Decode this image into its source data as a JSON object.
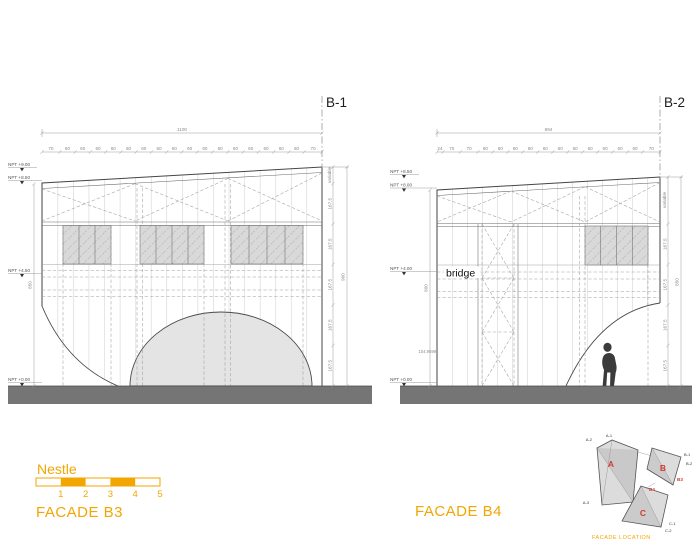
{
  "facade_b3": {
    "title": "FACADE B3",
    "section_label": "B-1",
    "overall_width": "1100",
    "tick_values": [
      "70",
      "60",
      "60",
      "60",
      "60",
      "60",
      "60",
      "60",
      "60",
      "60",
      "60",
      "60",
      "60",
      "60",
      "60",
      "60",
      "60",
      "70"
    ],
    "levels": [
      "NPT  +9.00",
      "NPT  +8.50",
      "NPT  +4.50",
      "NPT  +0.00"
    ],
    "left_height": "850",
    "right_dims": [
      "167.5",
      "167.5",
      "167.5",
      "167.5",
      "167.5"
    ],
    "variable_label": "variable",
    "overall_height": "900"
  },
  "facade_b4": {
    "title": "FACADE B4",
    "section_label": "B-2",
    "overall_width": "894",
    "tick_values": [
      "24",
      "70",
      "70",
      "60",
      "60",
      "60",
      "60",
      "60",
      "60",
      "60",
      "60",
      "60",
      "60",
      "60",
      "70"
    ],
    "levels": [
      "NPT  +8.50",
      "NPT  +8.00",
      "NPT  +4.00",
      "NPT  +0.00"
    ],
    "bridge_label": "bridge",
    "note": "104.9599",
    "left_height": "800",
    "right_dims": [
      "167.5",
      "167.5",
      "167.5",
      "167.5"
    ],
    "variable_label": "variable",
    "overall_height": "850"
  },
  "legend": {
    "scale_name": "Nestle",
    "scale_numbers": [
      "1",
      "2",
      "3",
      "4",
      "5"
    ]
  },
  "keyplan": {
    "title": "FACADE LOCATION",
    "shape_a": "A",
    "shape_b": "B",
    "shape_c": "C",
    "corner_a1": "A-1",
    "corner_a2": "A-2",
    "corner_a3": "A-3",
    "corner_b1": "B-1",
    "corner_b2": "B-2",
    "corner_c1": "C-1",
    "corner_c2": "C-2",
    "ref_b3": "B3",
    "ref_b4": "B4"
  },
  "colors": {
    "accent": "#F2A602",
    "red": "#D23B32"
  }
}
